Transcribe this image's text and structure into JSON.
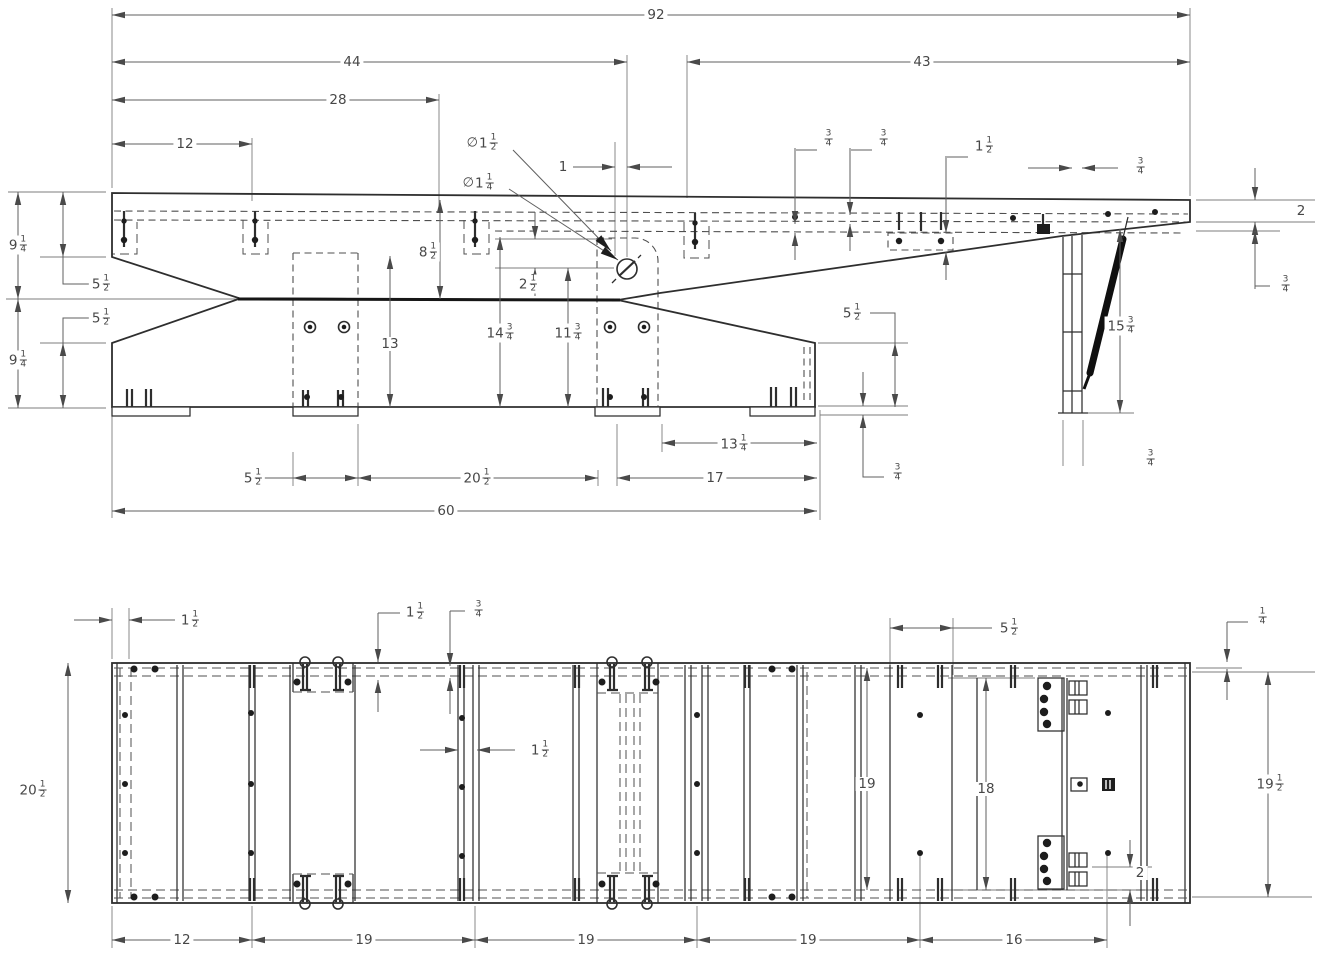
{
  "drawing": {
    "background_color": "#ffffff",
    "ink_color": "#2e2e2e",
    "dim_color": "#5f5f5f",
    "units_note": "",
    "views": {
      "side_elevation": {
        "dimensions": [
          {
            "value": "92",
            "x": 656,
            "y": 15
          },
          {
            "value": "44",
            "x": 352,
            "y": 62
          },
          {
            "value": "43",
            "x": 922,
            "y": 62
          },
          {
            "value": "28",
            "x": 338,
            "y": 100
          },
          {
            "value": "12",
            "x": 185,
            "y": 144
          },
          {
            "value": "∅1 1/2",
            "x": 482,
            "y": 143
          },
          {
            "value": "∅1 1/4",
            "x": 478,
            "y": 183
          },
          {
            "value": "1",
            "x": 563,
            "y": 167
          },
          {
            "value": "3/4",
            "x": 828,
            "y": 139
          },
          {
            "value": "3/4",
            "x": 883,
            "y": 139
          },
          {
            "value": "1 1/2",
            "x": 984,
            "y": 146
          },
          {
            "value": "3/4",
            "x": 1140,
            "y": 167
          },
          {
            "value": "2",
            "x": 1301,
            "y": 211
          },
          {
            "value": "3/4",
            "x": 1285,
            "y": 285
          },
          {
            "value": "15 3/4",
            "x": 1121,
            "y": 326
          },
          {
            "value": "5 1/2",
            "x": 852,
            "y": 313
          },
          {
            "value": "3/4",
            "x": 897,
            "y": 473
          },
          {
            "value": "3/4",
            "x": 1150,
            "y": 459
          },
          {
            "value": "9 1/4",
            "x": 18,
            "y": 245
          },
          {
            "value": "5 1/2",
            "x": 101,
            "y": 284
          },
          {
            "value": "5 1/2",
            "x": 101,
            "y": 318
          },
          {
            "value": "9 1/4",
            "x": 18,
            "y": 360
          },
          {
            "value": "8 1/2",
            "x": 428,
            "y": 252
          },
          {
            "value": "2 1/2",
            "x": 528,
            "y": 284
          },
          {
            "value": "13",
            "x": 390,
            "y": 344
          },
          {
            "value": "14 3/4",
            "x": 500,
            "y": 333
          },
          {
            "value": "11 3/4",
            "x": 568,
            "y": 333
          },
          {
            "value": "13 1/4",
            "x": 734,
            "y": 444
          },
          {
            "value": "5 1/2",
            "x": 253,
            "y": 478
          },
          {
            "value": "20 1/2",
            "x": 477,
            "y": 478
          },
          {
            "value": "17",
            "x": 715,
            "y": 478
          },
          {
            "value": "60",
            "x": 446,
            "y": 511
          }
        ]
      },
      "plan": {
        "dimensions": [
          {
            "value": "1 1/2",
            "x": 190,
            "y": 620
          },
          {
            "value": "1 1/2",
            "x": 415,
            "y": 612
          },
          {
            "value": "3/4",
            "x": 478,
            "y": 610
          },
          {
            "value": "5 1/2",
            "x": 1009,
            "y": 628
          },
          {
            "value": "1/4",
            "x": 1262,
            "y": 617
          },
          {
            "value": "20 1/2",
            "x": 33,
            "y": 790
          },
          {
            "value": "1 1/2",
            "x": 540,
            "y": 750
          },
          {
            "value": "19",
            "x": 867,
            "y": 784
          },
          {
            "value": "18",
            "x": 986,
            "y": 789
          },
          {
            "value": "19 1/2",
            "x": 1270,
            "y": 784
          },
          {
            "value": "2",
            "x": 1140,
            "y": 873
          },
          {
            "value": "12",
            "x": 182,
            "y": 940
          },
          {
            "value": "19",
            "x": 364,
            "y": 940
          },
          {
            "value": "19",
            "x": 586,
            "y": 940
          },
          {
            "value": "19",
            "x": 808,
            "y": 940
          },
          {
            "value": "16",
            "x": 1014,
            "y": 940
          }
        ]
      }
    }
  }
}
